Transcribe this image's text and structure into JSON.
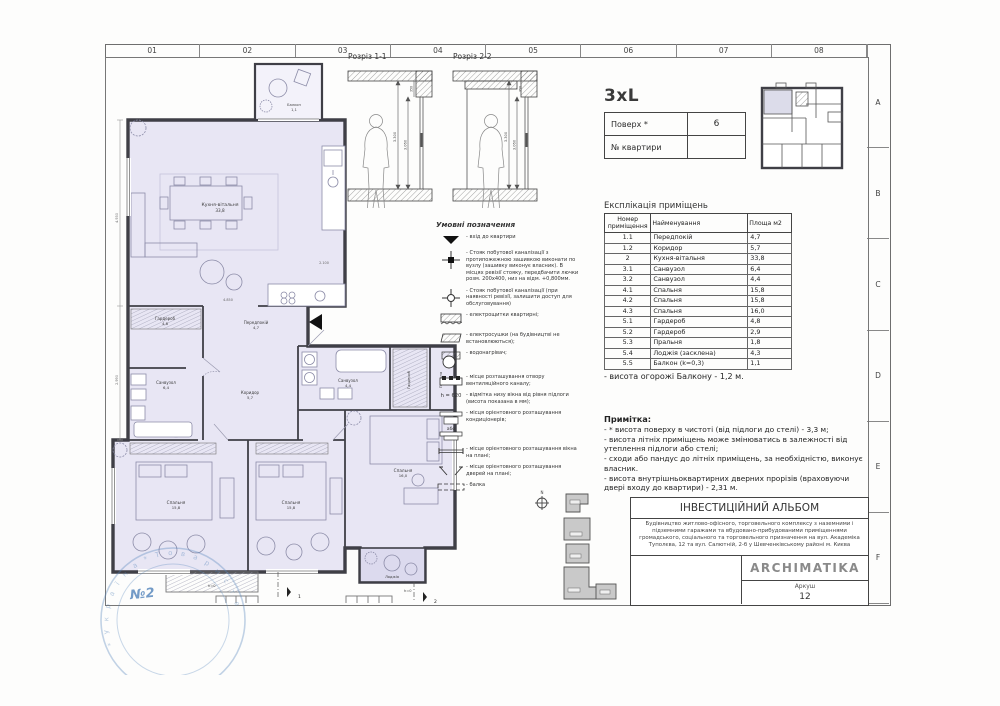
{
  "grid": {
    "cols": [
      "01",
      "02",
      "03",
      "04",
      "05",
      "06",
      "07",
      "08"
    ],
    "rows": [
      "A",
      "B",
      "C",
      "D",
      "E",
      "F"
    ]
  },
  "sections": {
    "s1_title": "Розріз 1-1",
    "s2_title": "Розріз 2-2",
    "dims": {
      "lintel": "350",
      "clear": "3.300",
      "window": "3.060"
    }
  },
  "apartment": {
    "type": "3xL",
    "floor_label": "Поверх *",
    "floor_value": "6",
    "number_label": "№ квартири",
    "number_value": ""
  },
  "explication": {
    "title": "Експлікація приміщень",
    "headers": [
      "Номер приміщення",
      "Найменування",
      "Площа м2"
    ],
    "rows": [
      {
        "num": "1.1",
        "name": "Передпокій",
        "area": "4,7"
      },
      {
        "num": "1.2",
        "name": "Коридор",
        "area": "5,7"
      },
      {
        "num": "2",
        "name": "Кухня-вітальня",
        "area": "33,8"
      },
      {
        "num": "3.1",
        "name": "Санвузол",
        "area": "6,4"
      },
      {
        "num": "3.2",
        "name": "Санвузол",
        "area": "4,4"
      },
      {
        "num": "4.1",
        "name": "Спальня",
        "area": "15,8"
      },
      {
        "num": "4.2",
        "name": "Спальня",
        "area": "15,8"
      },
      {
        "num": "4.3",
        "name": "Спальня",
        "area": "16,0"
      },
      {
        "num": "5.1",
        "name": "Гардероб",
        "area": "4,8"
      },
      {
        "num": "5.2",
        "name": "Гардероб",
        "area": "2,9"
      },
      {
        "num": "5.3",
        "name": "Пральня",
        "area": "1,8"
      },
      {
        "num": "5.4",
        "name": "Лоджія (засклена)",
        "area": "4,3"
      },
      {
        "num": "5.5",
        "name": "Балкон (k=0,3)",
        "area": "1,1"
      }
    ]
  },
  "balcony_note": "- висота огорожі Балкону - 1,2 м.",
  "note": {
    "title": "Примітка:",
    "lines": [
      "- * висота поверху в чистоті (від підлоги до стелі) - 3,3 м;",
      "- висота літніх приміщень може змінюватись в залежності від утеплення підлоги або стелі;",
      "- сходи або пандус до літніх приміщень, за необхідністю, виконує власник.",
      "- висота внутрішньоквартирних дверних прорізів (враховуючи двері входу до квартири) - 2,31 м."
    ]
  },
  "legend": {
    "title": "Умовні позначення",
    "items": [
      {
        "text": "- вхід до квартири"
      },
      {
        "text": "- Стояк побутової каналізації з протипожежною зашивкою виконати по вузлу (зашивку виконує власник). В місцях ревізії стояку, передбачити лючки розм. 200х400, низ на відм. +0,800мм."
      },
      {
        "text": "- Стояк побутової каналізації (при наявності ревізії, залишити доступ для обслуговування)"
      },
      {
        "text": "- електрощитки квартирні;"
      },
      {
        "text": "- електросушки (на будівництві не встановлюються);"
      },
      {
        "text": "- водонагрівач;"
      },
      {
        "text": "- місце розташування отвору вентиляційного каналу;"
      },
      {
        "icon_text": "h = 620",
        "text": "- відмітка низу вікна від рівня підлоги (висота показана в мм);"
      },
      {
        "icon_text": "або",
        "text": "- місця орієнтовного розташування кондиціонерів;"
      },
      {
        "text": "- місце орієнтовного розташування вікна на плані;"
      },
      {
        "text": "- місце орієнтовного розташування дверей на плані;"
      },
      {
        "text": "- балка"
      }
    ]
  },
  "plan": {
    "rooms": [
      {
        "name": "Кухня-вітальня",
        "area": "33,8"
      },
      {
        "name": "Гардероб",
        "area": "4,8"
      },
      {
        "name": "Передпокій",
        "area": "4,7"
      },
      {
        "name": "Санвузол",
        "area": "6,4"
      },
      {
        "name": "Коридор",
        "area": "5,7"
      },
      {
        "name": "Санвузол",
        "area": "4,4"
      },
      {
        "name": "Гардероб",
        "area": "2,9"
      },
      {
        "name": "Пральня",
        "area": "1,8"
      },
      {
        "name": "Спальня",
        "area": "15,8"
      },
      {
        "name": "Спальня",
        "area": "15,8"
      },
      {
        "name": "Спальня",
        "area": "16,0"
      },
      {
        "name": "Лоджія",
        "area": "4,3"
      },
      {
        "name": "Балкон",
        "area": "1,1"
      }
    ],
    "dims": [
      "4.930",
      "2.990",
      "3.450",
      "3.450",
      "3.250",
      "4.850",
      "2.100"
    ],
    "marks": {
      "h0_left": "h=0",
      "h0_right": "h=0",
      "sec1": "1",
      "sec2": "2"
    }
  },
  "titleblock": {
    "album": "ІНВЕСТИЦІЙНИЙ АЛЬБОМ",
    "description": "Будівництво житлово-офісного, торговельного комплексу з наземними і підземними гаражами та вбудовано-прибудованими приміщеннями громадського, соціального та торговельного призначення на вул. Академіка Туполєва, 12 та вул. Салютній, 2-б у Шевченківському районі м. Києва",
    "brand": "ARCHIMATIKA",
    "sheet_label": "Аркуш",
    "sheet_value": "12"
  },
  "stamp": {
    "number": "№2"
  },
  "colors": {
    "floor_fill": "#e8e6f4",
    "wall": "#3f3f46",
    "furniture": "#8c8ca8",
    "stamp_blue": "#5082b9"
  }
}
